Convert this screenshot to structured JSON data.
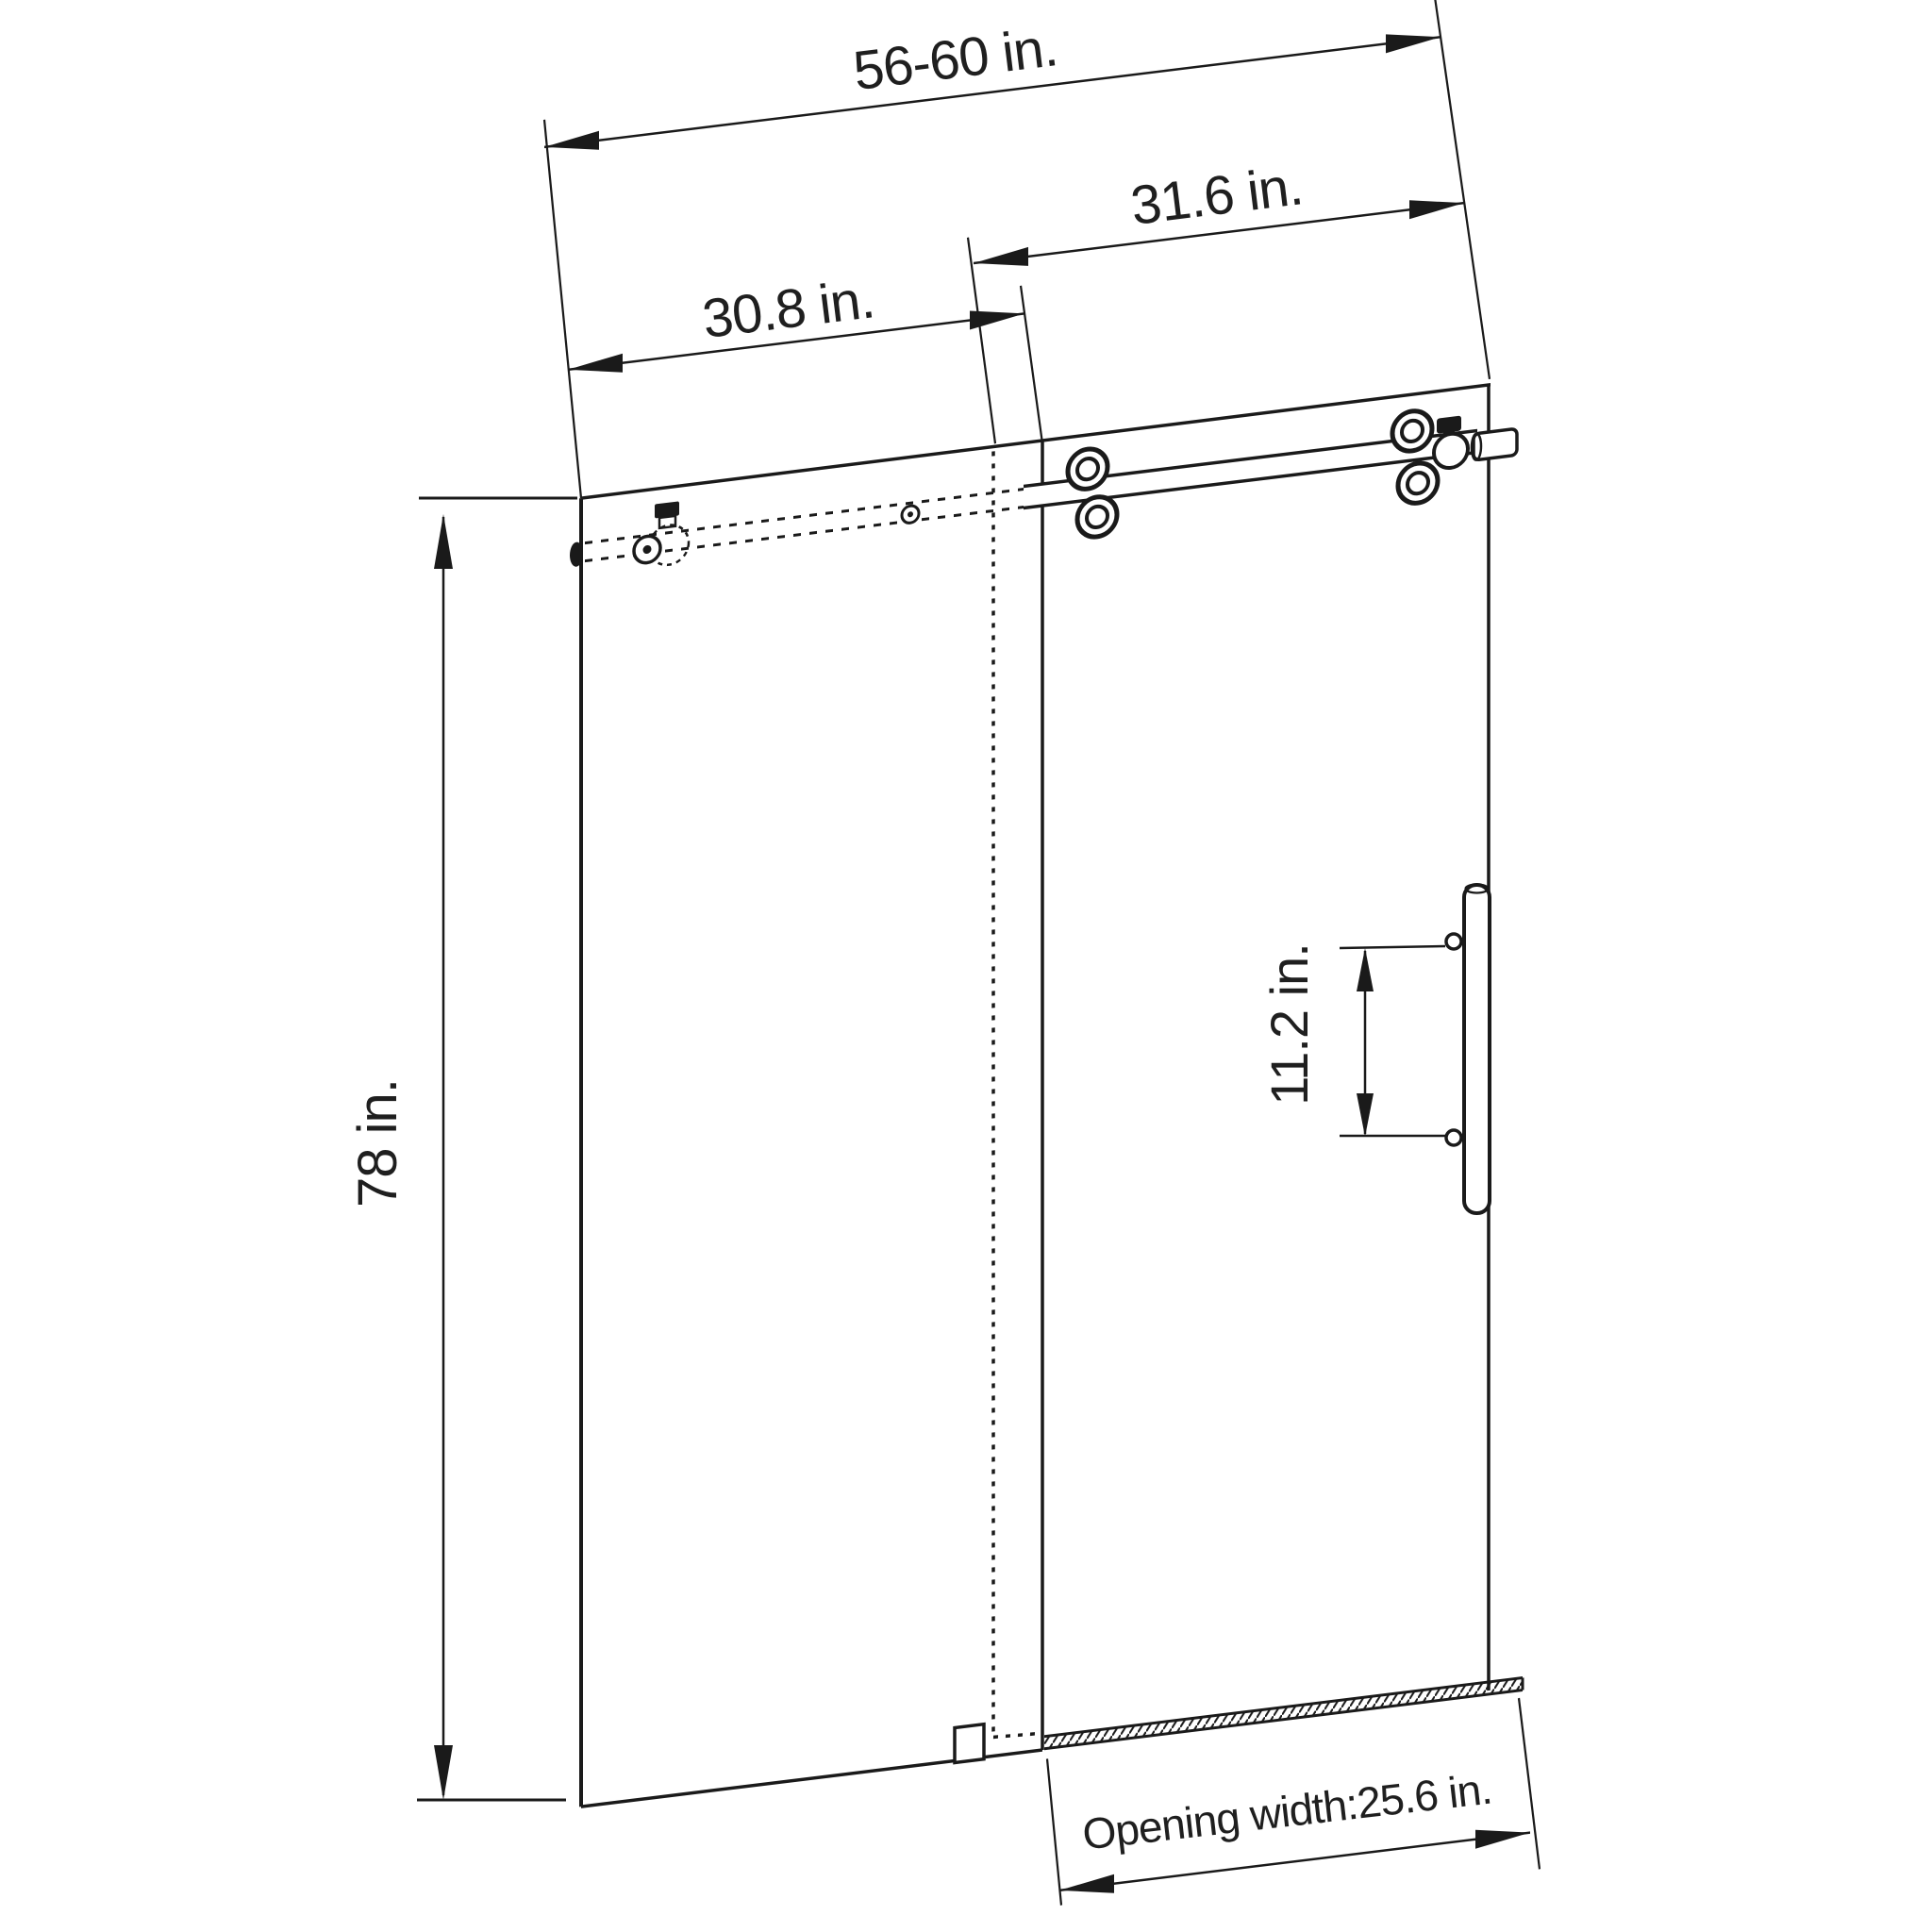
{
  "page": {
    "background_color": "#ffffff",
    "drawing_type": "technical dimension diagram",
    "subject": "frameless sliding shower door elevation",
    "line_color": "#1a1a1a",
    "unit": "in."
  },
  "dimension_labels": {
    "overall_width": "56-60 in.",
    "sliding_panel_width": "31.6 in.",
    "fixed_panel_width": "30.8 in.",
    "door_height": "78 in.",
    "handle_spacing": "11.2 in.",
    "opening_width": "Opening width:25.6 in."
  },
  "dimension_values": {
    "overall_width_range_in": [
      56,
      60
    ],
    "sliding_panel_width_in": 31.6,
    "fixed_panel_width_in": 30.8,
    "door_height_in": 78,
    "handle_spacing_in": 11.2,
    "opening_width_in": 25.6
  }
}
